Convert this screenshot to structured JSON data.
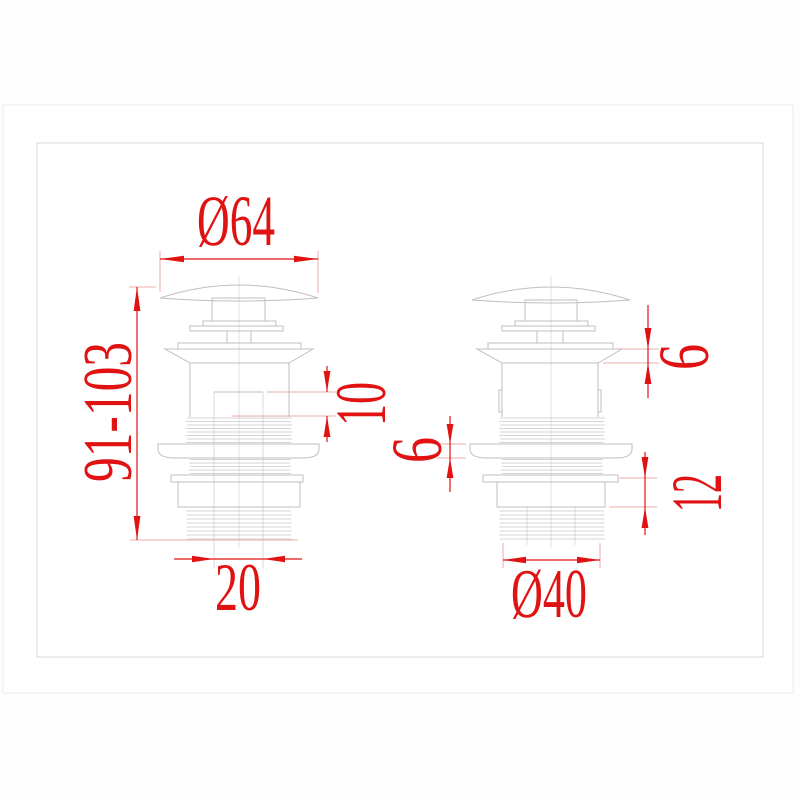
{
  "colors": {
    "dimension_red": "#e01212",
    "extension_pink": "#eeada6",
    "outline_gray": "#bfbfbf",
    "centerline_gray": "#d9d9d9",
    "frame_gray": "#d9d9d9",
    "page_border_gray": "#ececec"
  },
  "views": {
    "left": {
      "cap_diameter": "Ø64",
      "overall_height_range": "91-103",
      "upper_body_height": "10",
      "outlet_bore_diameter": "20"
    },
    "right": {
      "flange_height": "6",
      "gasket_thickness": "6",
      "locknut_height": "12",
      "tail_thread_diameter": "Ø40"
    }
  }
}
